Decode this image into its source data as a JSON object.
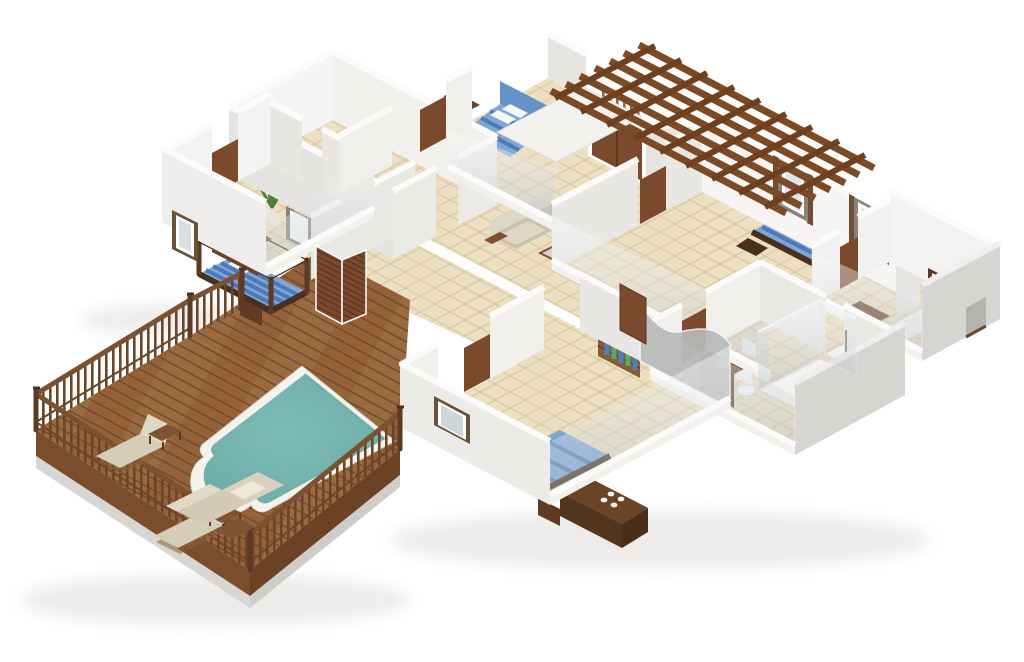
{
  "scene": {
    "type": "3d-floor-plan-render",
    "view": "isometric-cutaway",
    "background": "#ffffff"
  },
  "colors": {
    "wall_top": "#fcfbfa",
    "wall_face_light": "#f3f2f0",
    "wall_face_mid": "#e8e6e3",
    "wall_face_shaded": "#dcdad6",
    "wall_exterior_gray": "#d7d5d1",
    "cut_wall_gray": "#b7bab9",
    "glass": "#c9d4d8",
    "floor_tile": "#ecdfc2",
    "tile_line": "#d8c5a2",
    "wood_deck": "#9a6a41",
    "wood_seam": "#6f4a2b",
    "wood_fascia_light": "#7a4e2c",
    "wood_fascia_dark": "#6b4226",
    "railing_wood": "#7b5131",
    "baluster_wood": "#6b452a",
    "door_wood": "#7b4a2d",
    "door_wood_dark": "#5f3620",
    "furniture_dark": "#5f3b22",
    "furniture_darker": "#4a2f1c",
    "pergola_wood": "#7c4a24",
    "pergola_wood_dark": "#6f3f1e",
    "pool_water": "#74b3ae",
    "pool_coping": "#f4f2ec",
    "bed_blue": "#4d79b6",
    "bed_blue_light": "#7fa6d6",
    "bed_headboard_blue": "#6592c8",
    "pillow_white": "#f7f7f5",
    "sofa_beige": "#c9c1ac",
    "cushion_beige": "#d5cdb8",
    "cushion_beige_light": "#ded7c4",
    "plant_green": "#4e7d38",
    "lamp_blue": "#4d7fc0",
    "fixture_white": "#f4f3ef",
    "concrete_base": "#d8d6d2"
  },
  "rooms": [
    {
      "id": "storage-rooms-top-left",
      "contents": [
        "empty room",
        "empty room"
      ]
    },
    {
      "id": "bedroom-left",
      "contents": [
        "four-poster double bed",
        "dresser with tv",
        "nightstand",
        "potted plant",
        "window"
      ]
    },
    {
      "id": "bedroom-top-center",
      "contents": [
        "double bed",
        "blue headboard panel",
        "side cabinet",
        "foot bench",
        "window"
      ]
    },
    {
      "id": "entry-hall",
      "contents": [
        "double wood door",
        "slatted screen",
        "pergola above"
      ]
    },
    {
      "id": "living-area",
      "contents": [
        "beige sofa",
        "coffee table"
      ]
    },
    {
      "id": "master-bedroom-right",
      "contents": [
        "double bed",
        "nightstand with blue lamp",
        "two windows"
      ]
    },
    {
      "id": "ensuite-bathroom",
      "contents": [
        "bathtub",
        "vanity cabinet",
        "mirror",
        "window"
      ]
    },
    {
      "id": "walk-in-closet",
      "contents": [
        "wood rack",
        "hanging clothes"
      ]
    },
    {
      "id": "main-bathroom",
      "contents": [
        "glass shower",
        "toilet",
        "vanity",
        "towels"
      ]
    },
    {
      "id": "wc-small",
      "contents": [
        "toilet",
        "louvered folding doors"
      ]
    },
    {
      "id": "bedroom-bottom",
      "contents": [
        "double bed",
        "dresser with decor dots",
        "nightstand",
        "window"
      ]
    },
    {
      "id": "pool-deck",
      "contents": [
        "swimming pool",
        "2 sun loungers",
        "outdoor sofa set",
        "side tables",
        "wood railing"
      ]
    }
  ],
  "pool": {
    "shape": "rectangle-with-roman-end",
    "water_color": "#74b3ae",
    "coping_color": "#f4f2ec"
  },
  "counts": {
    "bedrooms": 4,
    "beds": 4,
    "bathrooms": 2,
    "sun_loungers": 2,
    "sofas": 2,
    "pools": 1,
    "pergolas": 1
  }
}
